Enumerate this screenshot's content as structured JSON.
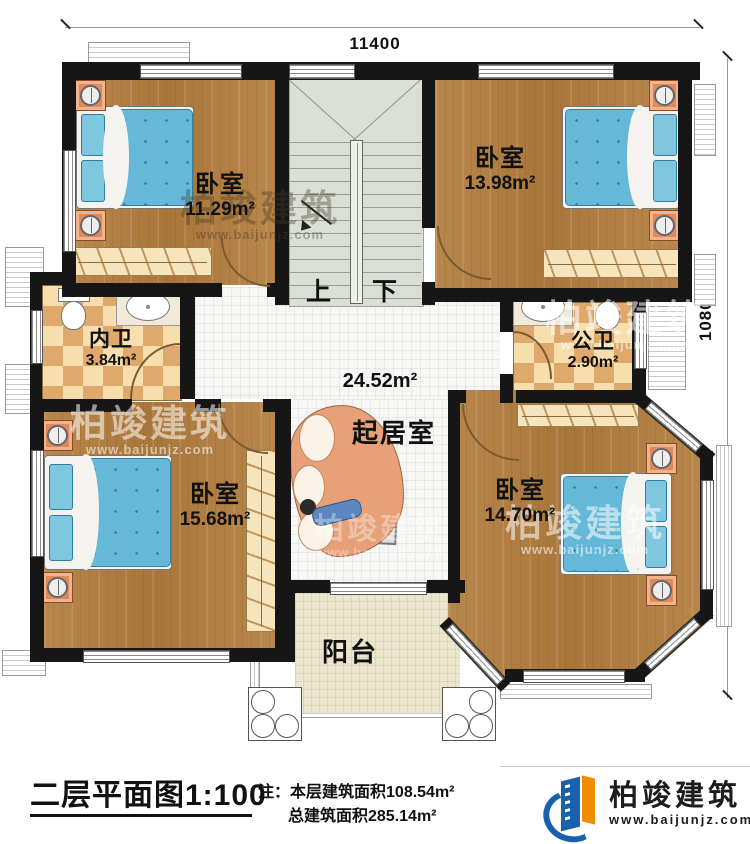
{
  "plan": {
    "dim_top": "11400",
    "dim_right": "10800",
    "stair_up": "上",
    "stair_down": "下",
    "rooms": {
      "bedroom_tl": {
        "name": "卧室",
        "area": "11.29m²"
      },
      "bedroom_tr": {
        "name": "卧室",
        "area": "13.98m²"
      },
      "bath_inner": {
        "name": "内卫",
        "area": "3.84m²"
      },
      "bath_public": {
        "name": "公卫",
        "area": "2.90m²"
      },
      "living": {
        "name": "起居室",
        "area": "24.52m²"
      },
      "bedroom_bl": {
        "name": "卧室",
        "area": "15.68m²"
      },
      "bedroom_br": {
        "name": "卧室",
        "area": "14.70m²"
      },
      "balcony": {
        "name": "阳台"
      }
    }
  },
  "watermark": {
    "brand": "柏竣建筑",
    "site": "www.baijunjz.com"
  },
  "footer": {
    "title": "二层平面图",
    "scale": "1:100",
    "note_label": "注：",
    "note1": "本层建筑面积108.54m²",
    "note2": "总建筑面积285.14m²",
    "brand": "柏竣建筑",
    "site": "www.baijunjz.com"
  },
  "colors": {
    "wall": "#161616",
    "wood": "#ad7b3c",
    "bed_blue": "#66b8d8",
    "brand_blue": "#1961ac",
    "brand_orange": "#f08c00"
  }
}
